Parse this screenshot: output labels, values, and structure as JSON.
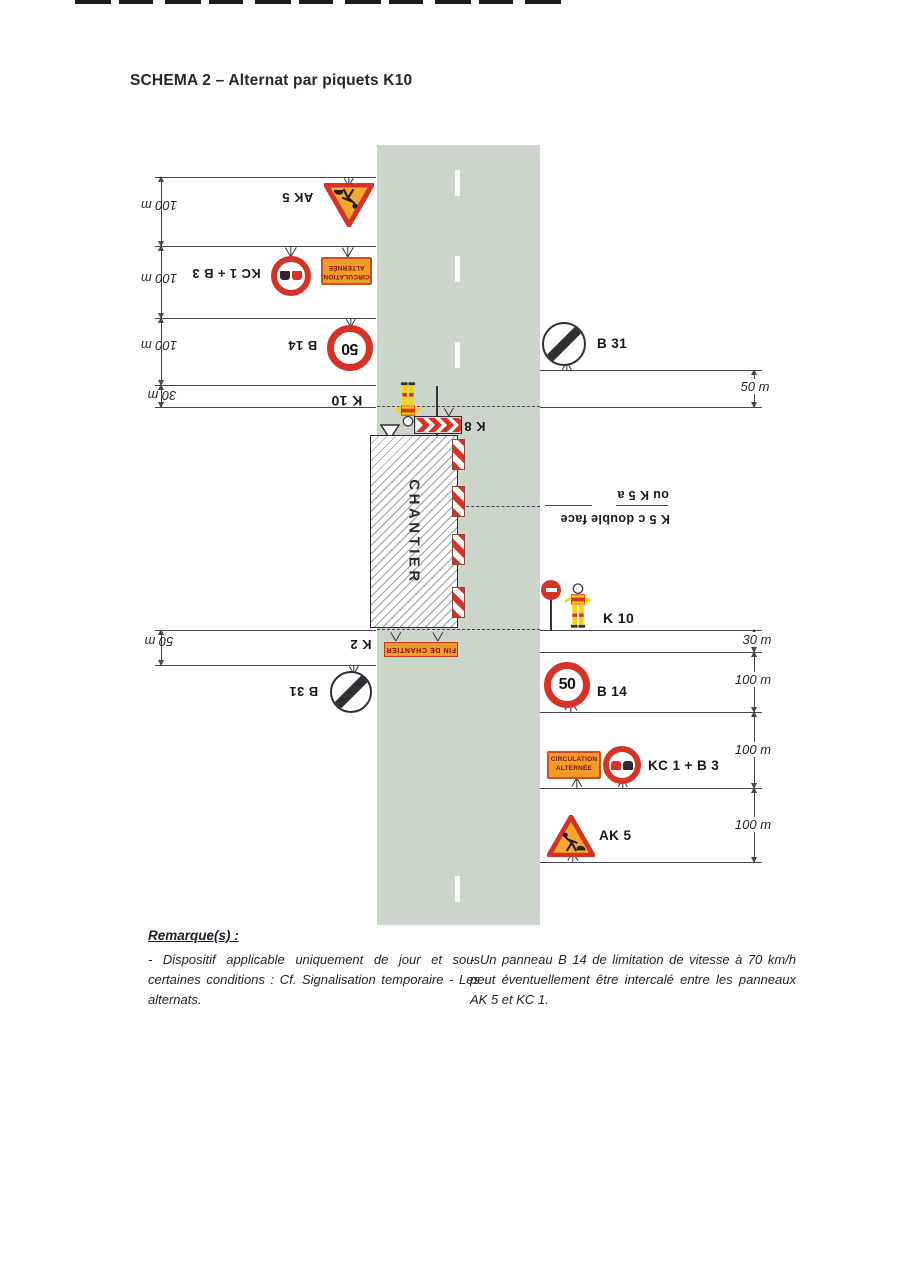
{
  "title": "SCHEMA 2 – Alternat par piquets K10",
  "signs": {
    "ak5": "AK 5",
    "kc1b3": "KC 1 + B 3",
    "b14": "B 14",
    "b31": "B 31",
    "k10": "K 10",
    "k8": "K 8",
    "k2": "K 2",
    "speed_value": "50",
    "kc1_line1": "CIRCULATION",
    "kc1_line2": "ALTERNÉE",
    "k2_panel": "FIN DE CHANTIER",
    "chantier": "CHANTIER",
    "k5c_label": "K 5 c double face",
    "k5c_alt": "ou K 5 a"
  },
  "distances": {
    "left": [
      "100 m",
      "100 m",
      "100 m",
      "30 m",
      "50 m"
    ],
    "right": [
      "50 m",
      "30 m",
      "100 m",
      "100 m",
      "100 m"
    ]
  },
  "remarks": {
    "heading": "Remarque(s) :",
    "col_left": "- Dispositif applicable uniquement de jour et sous certaines conditions : Cf. Signalisation temporaire - Les alternats.",
    "col_right": "- Un panneau B 14 de limitation de vitesse à 70 km/h peut éventuellement être intercalé entre les panneaux AK 5 et KC 1."
  },
  "icons": {
    "ak5": "roadworks-warning-triangle",
    "b14": "speed-limit-ring",
    "b3": "no-overtaking-ring",
    "b31": "end-of-prohibition-circle",
    "k8": "chevron-barrier",
    "k5c": "striped-delineator-post",
    "k10": "flagger-with-paddle"
  },
  "colors": {
    "road": "#ccd5c9",
    "sign_red": "#d63226",
    "sign_orange": "#f19b2c",
    "sign_yellow": "#ffd100",
    "line": "#45454a",
    "text": "#23232d"
  }
}
